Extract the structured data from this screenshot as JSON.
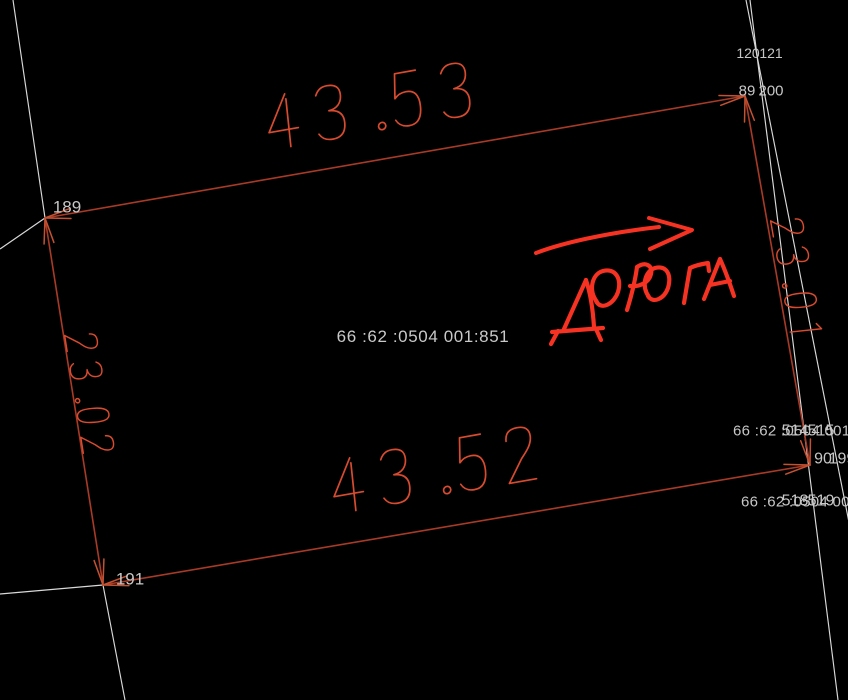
{
  "app": {
    "type": "cadastral-plan-view",
    "background": "#000000"
  },
  "colors": {
    "background": "#000000",
    "parcel_boundary_red": "#a83a26",
    "arrowhead_red": "#c25232",
    "dimension_text_red": "#d84b2f",
    "road_marker_red": "#f63222",
    "cadastral_grid_white": "#d9d9d9",
    "label_gray": "#c7c7c7"
  },
  "parcel": {
    "cadastral_number": "66 :62 :0504 001:851",
    "dimensions": [
      {
        "side": "top",
        "value": "43.53"
      },
      {
        "side": "bottom",
        "value": "43.52"
      },
      {
        "side": "left",
        "value": "23.02"
      },
      {
        "side": "right",
        "value": "23.01"
      }
    ],
    "road_annotation": {
      "text": "ДОРОГА",
      "arrow_direction": "right"
    }
  },
  "point_labels": [
    {
      "text": "120",
      "x": 748,
      "y": 53,
      "size": 14
    },
    {
      "text": "121",
      "x": 771,
      "y": 53,
      "size": 14
    },
    {
      "text": "89",
      "x": 747,
      "y": 91,
      "size": 15
    },
    {
      "text": "200",
      "x": 771,
      "y": 91,
      "size": 15
    },
    {
      "text": "189",
      "x": 67,
      "y": 207,
      "size": 17
    },
    {
      "text": "191",
      "x": 130,
      "y": 579,
      "size": 17
    },
    {
      "text": "514",
      "x": 795,
      "y": 431,
      "size": 16
    },
    {
      "text": "515",
      "x": 821,
      "y": 431,
      "size": 16
    },
    {
      "text": "90",
      "x": 823,
      "y": 459,
      "size": 16
    },
    {
      "text": "199",
      "x": 842,
      "y": 459,
      "size": 16
    },
    {
      "text": "518",
      "x": 795,
      "y": 501,
      "size": 16
    },
    {
      "text": "519",
      "x": 821,
      "y": 501,
      "size": 16
    }
  ],
  "adjacent_parcel_labels": [
    {
      "text": "66 :62 :0504 001",
      "x": 733,
      "y": 431,
      "size": 15
    },
    {
      "text": "66 :62 :0504 001",
      "x": 741,
      "y": 502,
      "size": 15
    }
  ],
  "geometry": {
    "canvas": {
      "width": 848,
      "height": 700
    },
    "parcel_corners": [
      [
        45,
        218
      ],
      [
        745,
        96
      ],
      [
        810,
        465
      ],
      [
        103,
        585
      ]
    ],
    "dimension_placements": {
      "top": {
        "x": 372,
        "y": 105,
        "rotate": -10,
        "height": 58
      },
      "bottom": {
        "x": 437,
        "y": 469,
        "rotate": -10,
        "height": 58
      },
      "left": {
        "x": 90,
        "y": 395,
        "rotate": 81,
        "height": 34
      },
      "right": {
        "x": 797,
        "y": 280,
        "rotate": 80,
        "height": 34
      }
    },
    "white_lines": [
      [
        13,
        0,
        45,
        218
      ],
      [
        45,
        218,
        0,
        249
      ],
      [
        0,
        594,
        103,
        585
      ],
      [
        103,
        585,
        125,
        700
      ],
      [
        750,
        0,
        838,
        700
      ],
      [
        746,
        0,
        884,
        700
      ]
    ],
    "center_label": {
      "x": 423,
      "y": 342,
      "size": 17
    }
  }
}
